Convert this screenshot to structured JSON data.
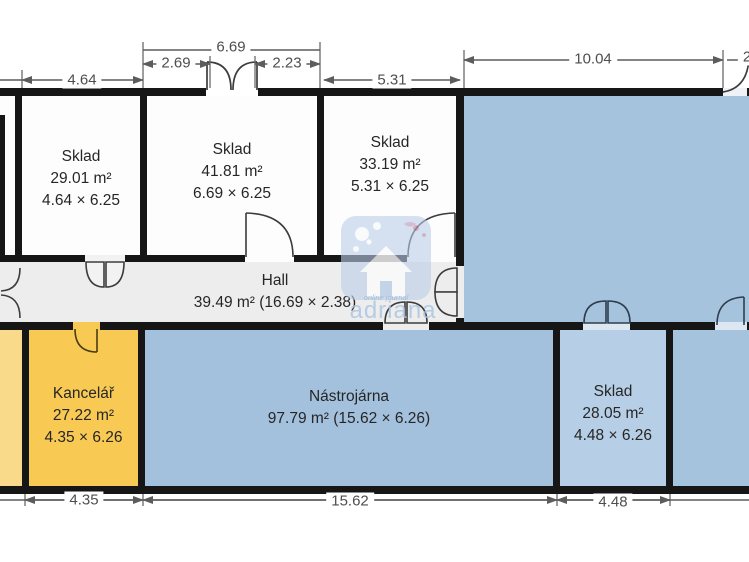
{
  "plan": {
    "title": "Floor plan",
    "rooms": [
      {
        "id": "sklad-1",
        "name": "Sklad",
        "area": "29.01 m²",
        "dims": "4.64 × 6.25"
      },
      {
        "id": "sklad-2",
        "name": "Sklad",
        "area": "41.81 m²",
        "dims": "6.69 × 6.25"
      },
      {
        "id": "sklad-3",
        "name": "Sklad",
        "area": "33.19 m²",
        "dims": "5.31 × 6.25"
      },
      {
        "id": "hall",
        "name": "Hall",
        "area": "39.49 m² (16.69 × 2.38)"
      },
      {
        "id": "kancelar",
        "name": "Kancelář",
        "area": "27.22 m²",
        "dims": "4.35 × 6.26"
      },
      {
        "id": "nastrojarna",
        "name": "Nástrojárna",
        "area": "97.79 m² (15.62 × 6.26)"
      },
      {
        "id": "sklad-4",
        "name": "Sklad",
        "area": "28.05 m²",
        "dims": "4.48 × 6.26"
      }
    ],
    "dimensions": {
      "top": [
        "4.64",
        "2.69",
        "6.69",
        "2.23",
        "5.31",
        "10.04",
        "2"
      ],
      "bottom": [
        "4.35",
        "15.62",
        "4.48"
      ]
    },
    "watermark": {
      "brand": "adriana",
      "tagline": "online journal"
    },
    "colors": {
      "room_blue": "#a6c3dd",
      "room_blue_light": "#b7cfe6",
      "room_yellow": "#f8ca54",
      "room_yellow_light": "#f9da8a",
      "hall_gray": "#ededed",
      "wall": "#161616",
      "dimension_gray": "#5c5c5c",
      "watermark_blue": "#b9cee7"
    }
  }
}
